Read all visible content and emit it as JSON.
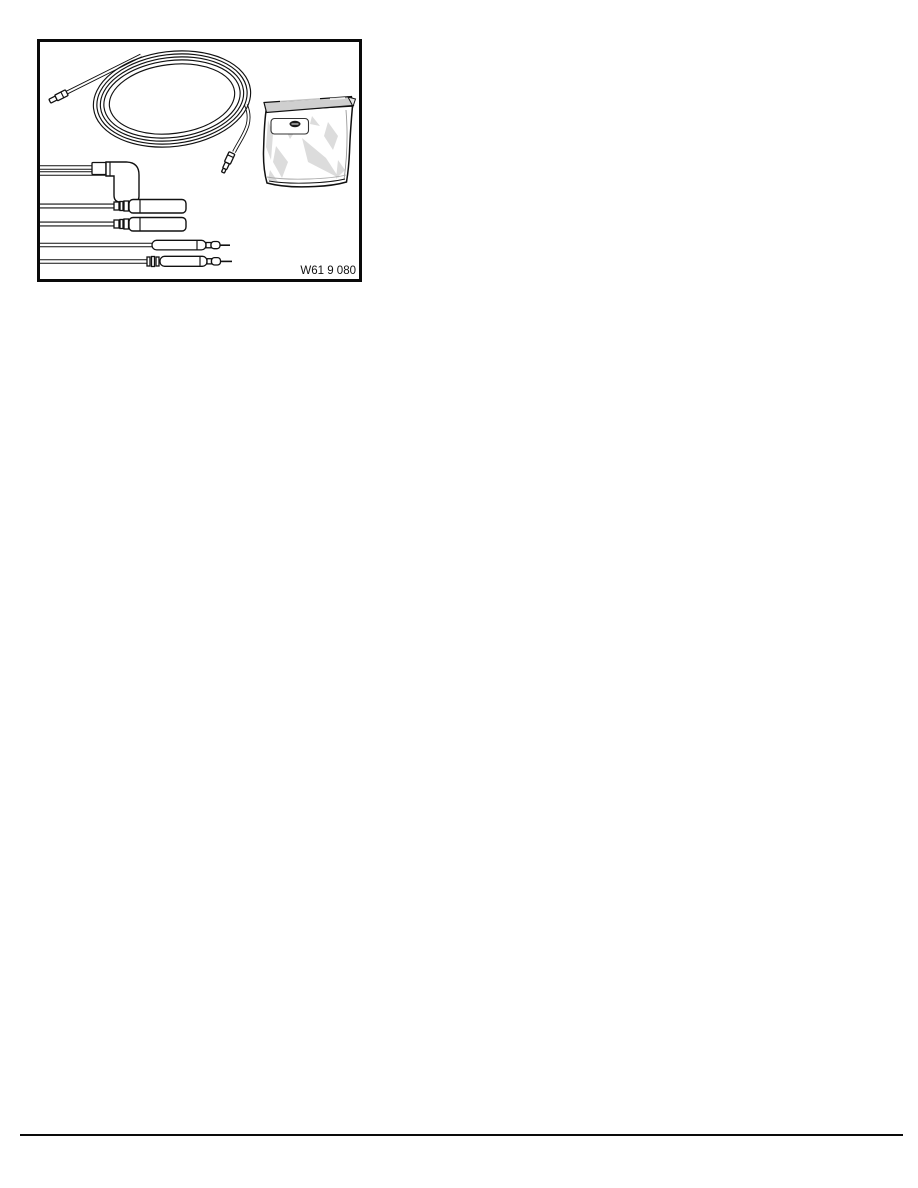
{
  "page": {
    "background_color": "#ffffff",
    "ink_color": "#111111"
  },
  "figure": {
    "label": "W61 9 080",
    "border_color": "#0a0a0a",
    "bag_shading_color": "#dcdcdc",
    "items": [
      {
        "icon": "coiled-cable-icon",
        "description": "long coiled cable with small plug terminal at each end"
      },
      {
        "icon": "right-angle-boot-lead-icon",
        "description": "lead with 90-degree angled connector boot"
      },
      {
        "icon": "plastic-bag-icon",
        "description": "sealed plastic bag with small label and logo"
      },
      {
        "icon": "sleeve-connector-leads-icon",
        "description": "two leads ending in cylindrical sleeve connectors"
      },
      {
        "icon": "test-probe-leads-icon",
        "description": "two leads ending in pointed test probes"
      }
    ]
  },
  "footer": {
    "rule_color": "#0a0a0a"
  }
}
